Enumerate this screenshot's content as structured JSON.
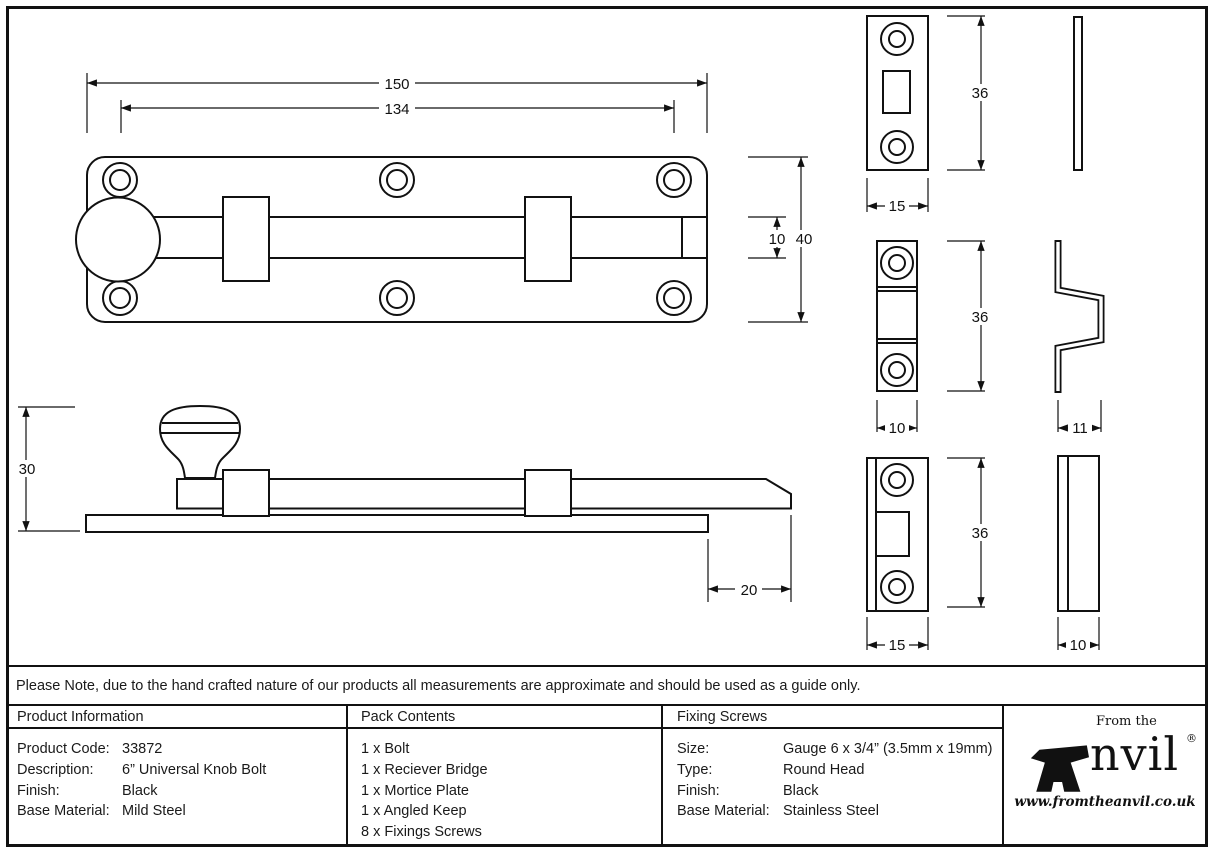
{
  "dims": {
    "overall_length": "150",
    "hole_spacing": "134",
    "plate_height": "40",
    "bolt_width": "10",
    "side_height": "30",
    "bolt_throw": "20",
    "mortice_height": "36",
    "mortice_width": "15",
    "bridge_height": "36",
    "bridge_width": "10",
    "bridge_depth": "11",
    "keep_height": "36",
    "keep_width": "15",
    "keep_depth": "10"
  },
  "note": "Please Note, due to the hand crafted nature of our products all measurements are approximate and should be used as a guide only.",
  "table": {
    "product_information": {
      "header": "Product Information",
      "rows": [
        {
          "label": "Product Code:",
          "value": "33872"
        },
        {
          "label": "Description:",
          "value": "6” Universal Knob Bolt"
        },
        {
          "label": "Finish:",
          "value": "Black"
        },
        {
          "label": "Base Material:",
          "value": "Mild Steel"
        }
      ]
    },
    "pack_contents": {
      "header": "Pack Contents",
      "items": [
        "1 x Bolt",
        "1 x Reciever Bridge",
        "1 x Mortice Plate",
        "1 x Angled Keep",
        "8 x Fixings Screws"
      ]
    },
    "fixing_screws": {
      "header": "Fixing Screws",
      "rows": [
        {
          "label": "Size:",
          "value": "Gauge 6 x 3/4” (3.5mm x 19mm)"
        },
        {
          "label": "Type:",
          "value": "Round Head"
        },
        {
          "label": "Finish:",
          "value": "Black"
        },
        {
          "label": "Base Material:",
          "value": "Stainless Steel"
        }
      ]
    }
  },
  "logo": {
    "tagline": "From the",
    "brand_rest": "nvil",
    "registered": "®",
    "url": "www.fromtheanvil.co.uk"
  }
}
